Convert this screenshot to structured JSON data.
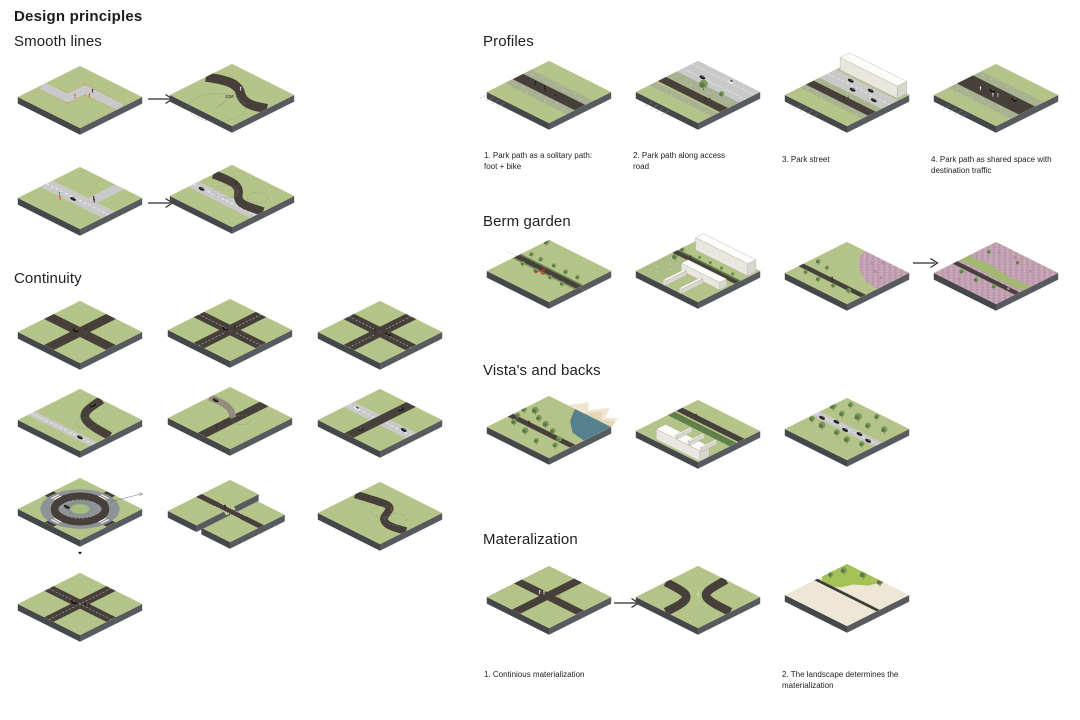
{
  "page": {
    "title": "Design principles"
  },
  "sections": {
    "smooth_lines": {
      "title": "Smooth lines",
      "tiles": [
        "zigzag-path",
        "arrow",
        "curve-20m",
        "road-crossing",
        "arrow",
        "s-curve-over-road"
      ]
    },
    "continuity": {
      "title": "Continuity",
      "tiles": [
        "crossroads-dark",
        "crossroads-marked",
        "crossroads-marked-2",
        "curve-junction",
        "y-merge",
        "cross-light-dark",
        "roundabout",
        "bridge-crossing",
        "s-bend",
        "crossroads-busy"
      ]
    },
    "profiles": {
      "title": "Profiles",
      "tiles": [
        "profile-solitary-path",
        "profile-access-road",
        "profile-park-street",
        "profile-shared-space"
      ],
      "captions": [
        "1. Park path as a solitary path: foot + bike",
        "2.  Park path along access road",
        "3. Park street",
        "4. Park path as shared space with destination traffic"
      ]
    },
    "berm_garden": {
      "title": "Berm garden",
      "tiles": [
        "berm-path-trees",
        "berm-gardens-buildings",
        "berm-meadow-road",
        "arrow",
        "berm-meadow-full"
      ]
    },
    "vistas": {
      "title": "Vista's and backs",
      "tiles": [
        "vista-water-mountains",
        "vista-hedge-building",
        "vista-tree-road"
      ]
    },
    "materialization": {
      "title": "Materalization",
      "tiles": [
        "continuous-materialization",
        "arrow",
        "merged-materialization",
        "landscape-materialization"
      ],
      "captions": [
        "1. Continious materialization",
        "2. The landscape determines the materialization"
      ]
    }
  },
  "annotations": {
    "curve_radius_label": "20M"
  },
  "palette": {
    "grass": "#b9c88e",
    "grass2": "#b0c083",
    "slab_left": "#44484b",
    "slab_right": "#575b5f",
    "path": "#473f39",
    "road": "#c9c9c9",
    "hedge": "#5e7d47",
    "tree": "#7d9a60",
    "tree2": "#597a43",
    "verge": "#a8b292",
    "water": "#55808d",
    "mountain": "#f0e6d2",
    "pink": "#c2a0b2",
    "pink2": "#b189a1",
    "gravel": "#efe8d7",
    "gravel2": "#ddd2b6",
    "red": "#d23a2c",
    "ink": "#1d1d1f"
  }
}
